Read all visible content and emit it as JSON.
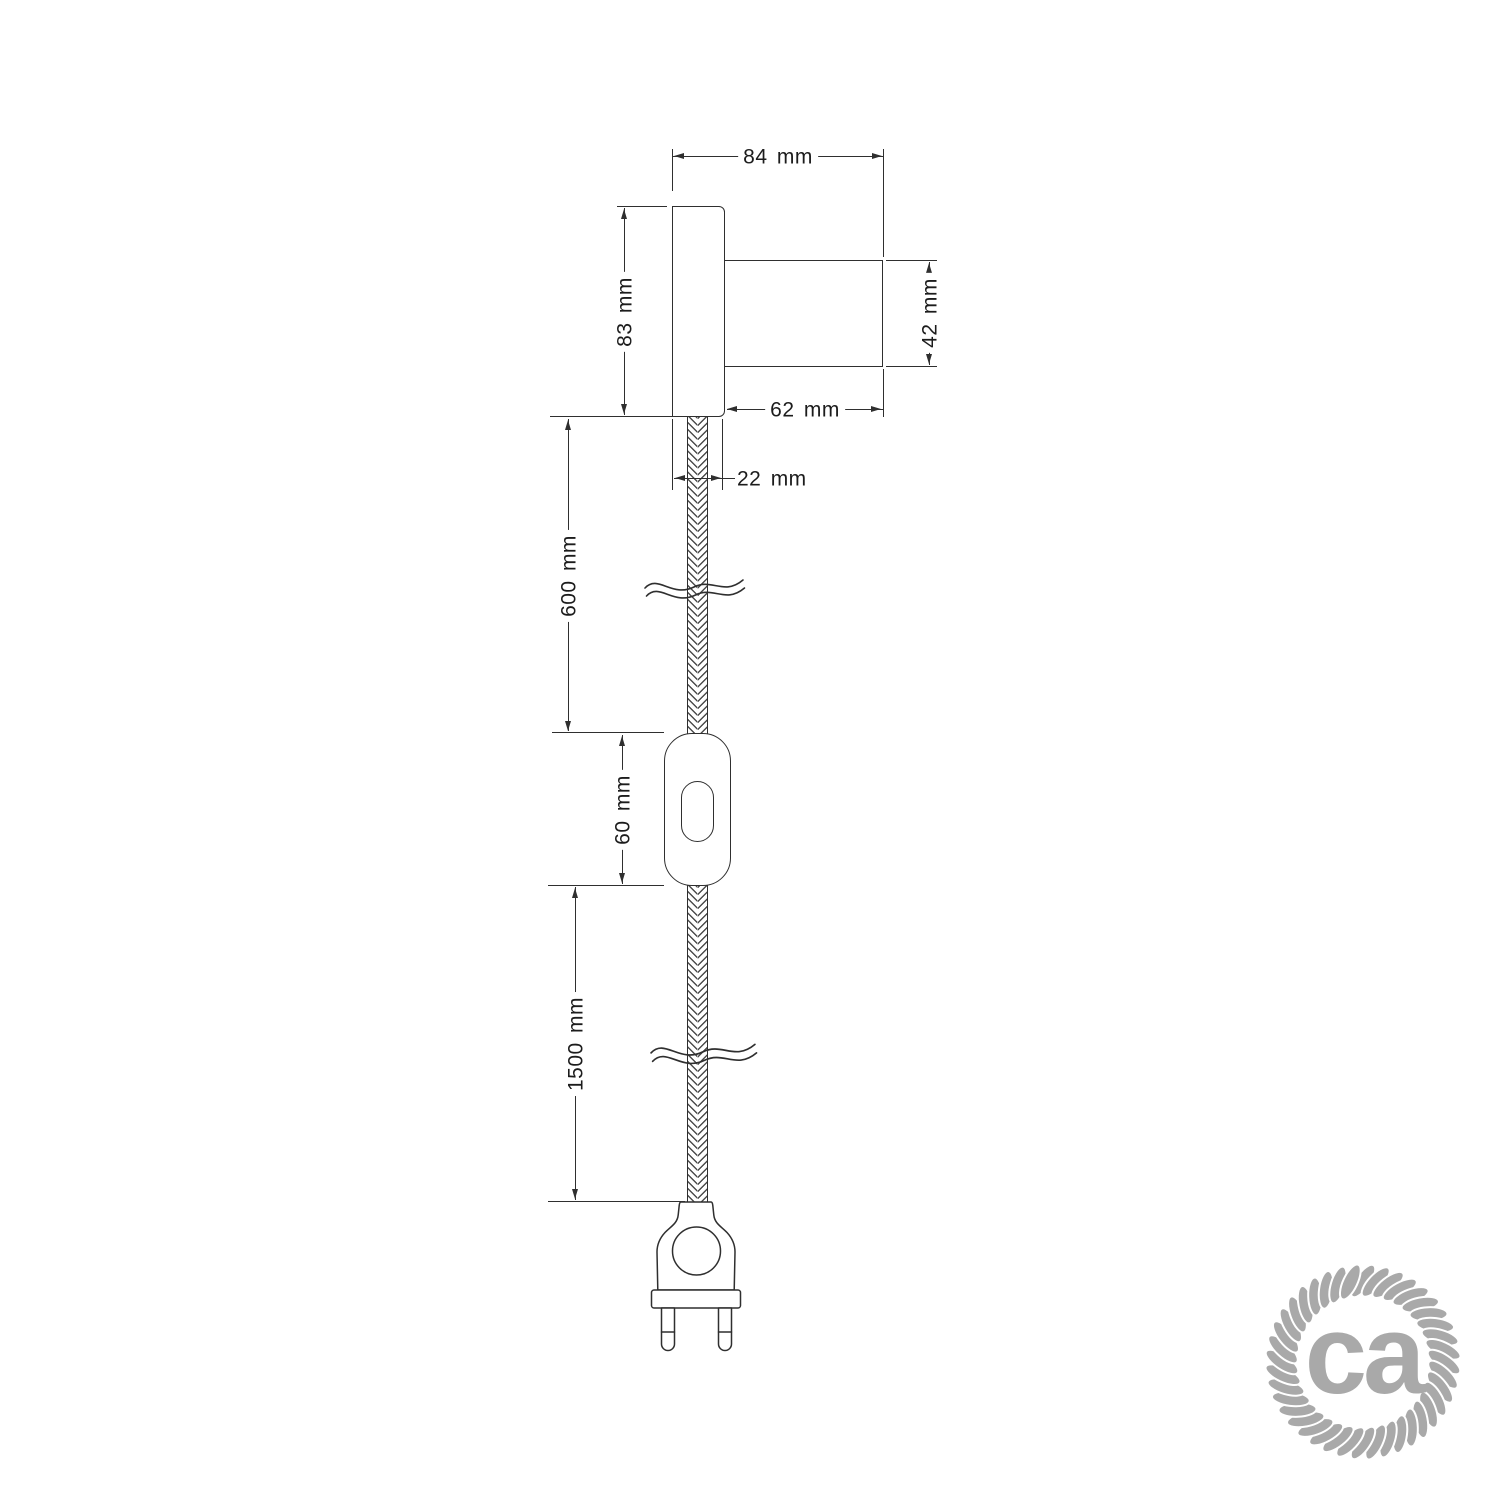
{
  "dims": {
    "total_depth": "84 mm",
    "plate_height": "83 mm",
    "socket_diameter": "42 mm",
    "socket_length": "62 mm",
    "plate_thickness": "22 mm",
    "upper_cable_length": "600 mm",
    "switch_length": "60 mm",
    "lower_cable_length": "1500 mm"
  },
  "logo": {
    "text": "ca"
  },
  "colors": {
    "line": "#2f2f2f",
    "logo_gray": "#a9a9a9",
    "background": "#ffffff"
  }
}
